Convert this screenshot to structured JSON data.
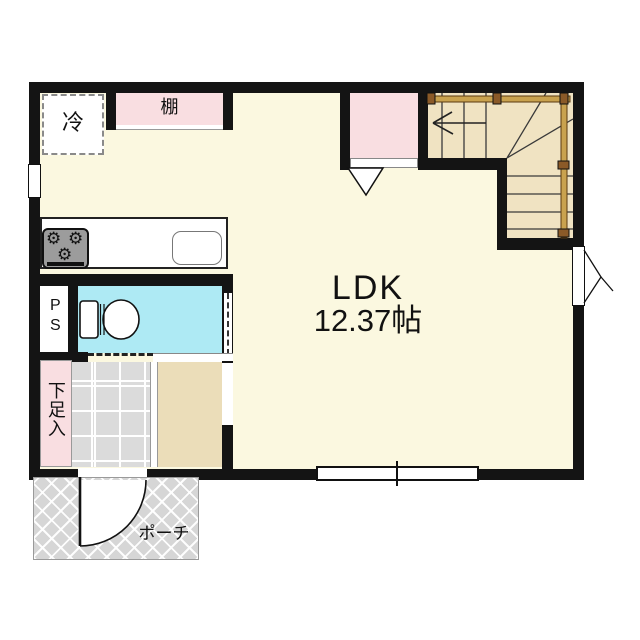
{
  "rooms": {
    "ldk": {
      "label": "LDK",
      "area": "12.37帖"
    },
    "pipe_space": {
      "label": "PS"
    },
    "shoe_cabinet": {
      "label": "下足入"
    },
    "porch": {
      "label": "ポーチ"
    },
    "shelf": {
      "label": "棚"
    },
    "refrigerator": {
      "label": "冷"
    }
  },
  "icons": {
    "stove_burner": "⚙"
  },
  "colors": {
    "wall": "#141414",
    "floor": "#FBF8E0",
    "accent_pink": "#F9DEE1",
    "washroom_cyan": "#AEEAF4",
    "hall_tan": "#EBDDB9",
    "stair_tan": "#F0E3C2",
    "tile_gray": "#DBDBDB",
    "porch_gray": "#D6D6D6",
    "handrail_brown": "#C9A24E"
  }
}
